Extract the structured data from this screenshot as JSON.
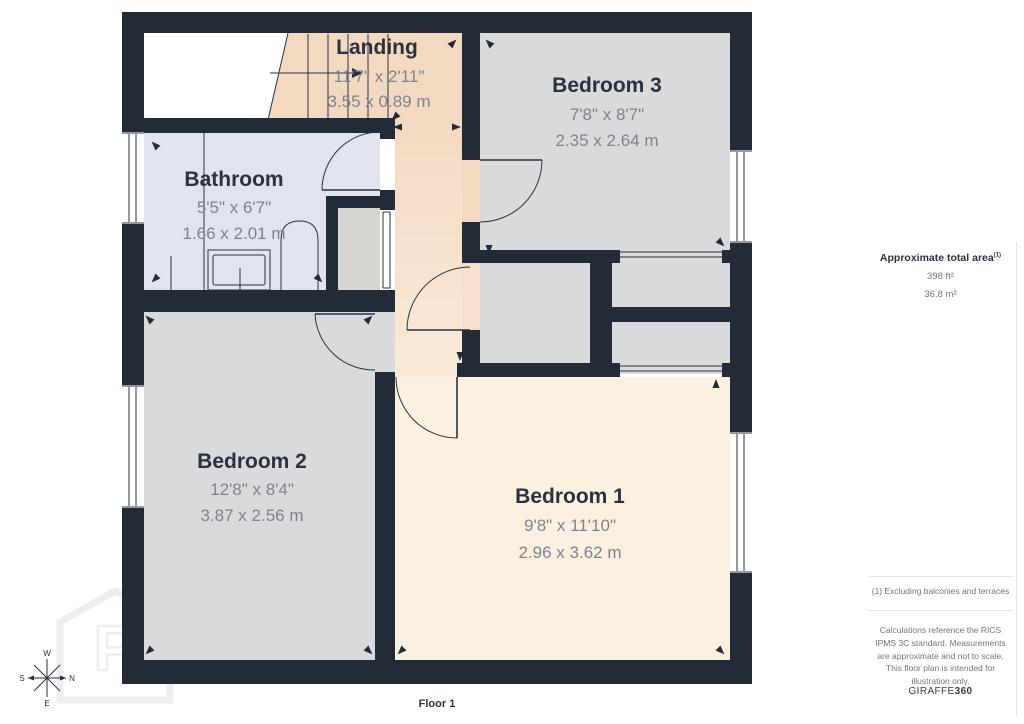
{
  "plan": {
    "rooms": [
      {
        "name": "Landing",
        "dims_ft": "11'7\" x 2'11\"",
        "dims_m": "3.55 x 0.89 m"
      },
      {
        "name": "Bedroom 3",
        "dims_ft": "7'8\" x 8'7\"",
        "dims_m": "2.35 x 2.64 m"
      },
      {
        "name": "Bathroom",
        "dims_ft": "5'5\" x 6'7\"",
        "dims_m": "1.66 x 2.01 m"
      },
      {
        "name": "Bedroom 2",
        "dims_ft": "12'8\" x 8'4\"",
        "dims_m": "3.87 x 2.56 m"
      },
      {
        "name": "Bedroom 1",
        "dims_ft": "9'8\" x 11'10\"",
        "dims_m": "2.96 x 3.62 m"
      }
    ],
    "floor_label": "Floor 1",
    "compass": {
      "top": "W",
      "left": "S",
      "right": "N",
      "bottom": "E"
    },
    "watermark_letter": "P"
  },
  "sidebar": {
    "area_title": "Approximate total area",
    "area_title_note": "(1)",
    "area_ft": "398 ft²",
    "area_m": "36.8 m²",
    "footnote": "(1) Excluding balconies and terraces",
    "disclaimer": "Calculations reference the RICS IPMS 3C standard. Measurements are approximate and not to scale. This floor plan is intended for illustration only.",
    "brand_prefix": "GIRAFFE",
    "brand_suffix": "360"
  },
  "colors": {
    "wall": "#232b39",
    "room_gray": "#d9dadc",
    "bathroom_blue": "#dfe4ee",
    "landing_peach": "#f4d9c2",
    "bedroom1_cream": "#fcf1e0",
    "dim_text": "#7d838e",
    "name_text": "#2a3240",
    "watermark": "#eceef1"
  }
}
